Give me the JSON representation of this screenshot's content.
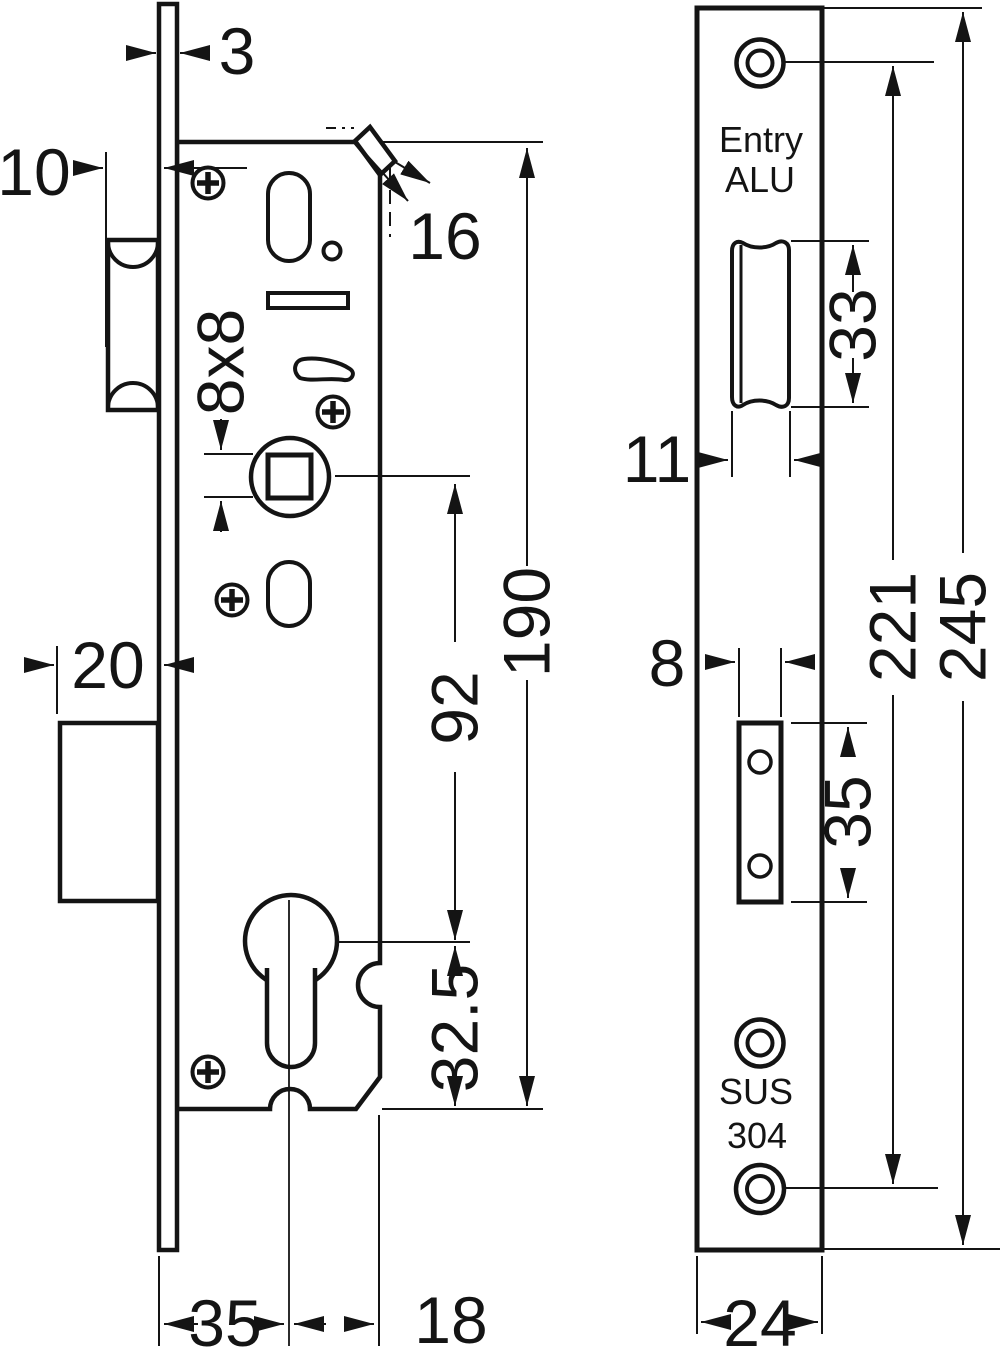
{
  "drawing": {
    "type": "technical-drawing",
    "subject": "narrow stile mortise lock, side view and faceplate front view",
    "side_view": {
      "dims": {
        "faceplate_thickness": "3",
        "latch_projection": "10",
        "latch_head_width": "16",
        "spindle_square": "8x8",
        "deadbolt_projection": "20",
        "spindle_to_cylinder": "92",
        "case_height": "190",
        "cylinder_to_case_bottom": "32.5",
        "backset": "35",
        "cylinder_to_case_back": "18"
      }
    },
    "front_view": {
      "plate_label": {
        "line1": "Entry",
        "line2": "ALU"
      },
      "material": {
        "line1": "SUS",
        "line2": "304"
      },
      "dims": {
        "latch_cutout_height": "33",
        "latch_cutout_width": "11",
        "screw_center_spacing": "221",
        "plate_height": "245",
        "bolt_cutout_width": "8",
        "bolt_cutout_height": "35",
        "plate_width": "24"
      }
    },
    "colors": {
      "ink": "#141414",
      "paper": "#ffffff"
    }
  }
}
